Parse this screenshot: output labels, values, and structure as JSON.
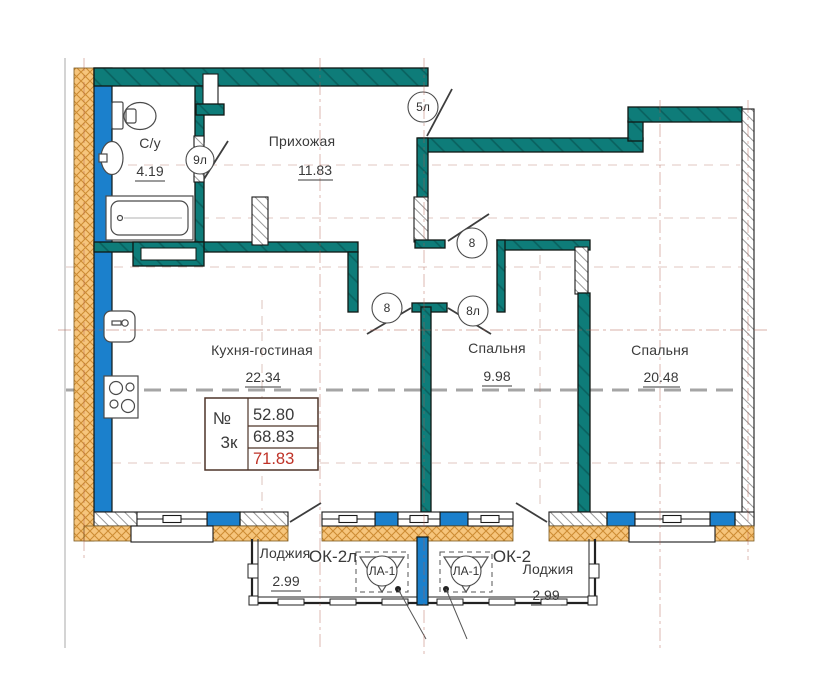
{
  "rooms": {
    "bathroom": {
      "name": "С/у",
      "area": "4.19"
    },
    "hallway": {
      "name": "Прихожая",
      "area": "11.83"
    },
    "kitchen": {
      "name": "Кухня-гостиная",
      "area": "22.34"
    },
    "bedroom1": {
      "name": "Спальня",
      "area": "9.98"
    },
    "bedroom2": {
      "name": "Спальня",
      "area": "20.48"
    }
  },
  "loggias": {
    "left": {
      "name": "Лоджия",
      "mark": "ОК-2л",
      "area": "2.99",
      "assembly": "ЛА-1"
    },
    "right": {
      "name": "Лоджия",
      "mark": "ОК-2",
      "area": "2.99",
      "assembly": "ЛА-1"
    }
  },
  "doors": {
    "entrance": "5л",
    "bathroom": "9л",
    "hall": "8",
    "kitchen": "8",
    "bedroom": "8л"
  },
  "table": {
    "number": "№",
    "type": "3к",
    "rows": [
      "52.80",
      "68.83",
      "71.83"
    ]
  },
  "colors": {
    "wall_teal": "#0e7c79",
    "wall_blue": "#1b80cc",
    "insulation": "#f6c57c",
    "highlight_red": "#bf3227"
  }
}
